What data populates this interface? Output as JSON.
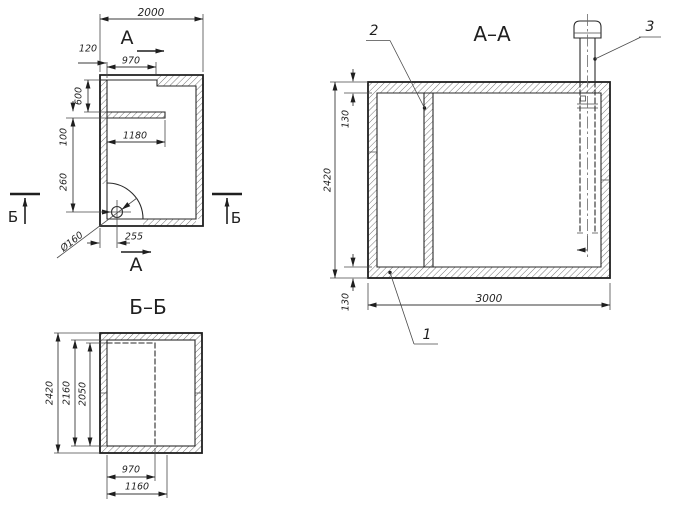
{
  "colors": {
    "line": "#1f1f1f",
    "background": "#ffffff"
  },
  "plan": {
    "marker_a": "А",
    "marker_b": "Б",
    "dim_overall_width": "2000",
    "dim_wall_thickness": "120",
    "dim_opening_width": "970",
    "dim_chamber_depth": "600",
    "dim_partition_thickness": "100",
    "dim_partition_length": "1180",
    "dim_pipe_offset_vert": "260",
    "dim_pipe_offset_horiz": "255",
    "dim_pipe_diameter": "Ø160"
  },
  "section_aa": {
    "title": "А–А",
    "dim_wall_top": "130",
    "dim_height": "2420",
    "dim_wall_bottom": "130",
    "dim_width": "3000",
    "callout_1": "1",
    "callout_2": "2",
    "callout_3": "3"
  },
  "section_bb": {
    "title": "Б–Б",
    "dim_outer_height": "2420",
    "dim_inner_height": "2160",
    "dim_opening_height": "2050",
    "dim_opening_width": "970",
    "dim_opening_outer_width": "1160"
  }
}
